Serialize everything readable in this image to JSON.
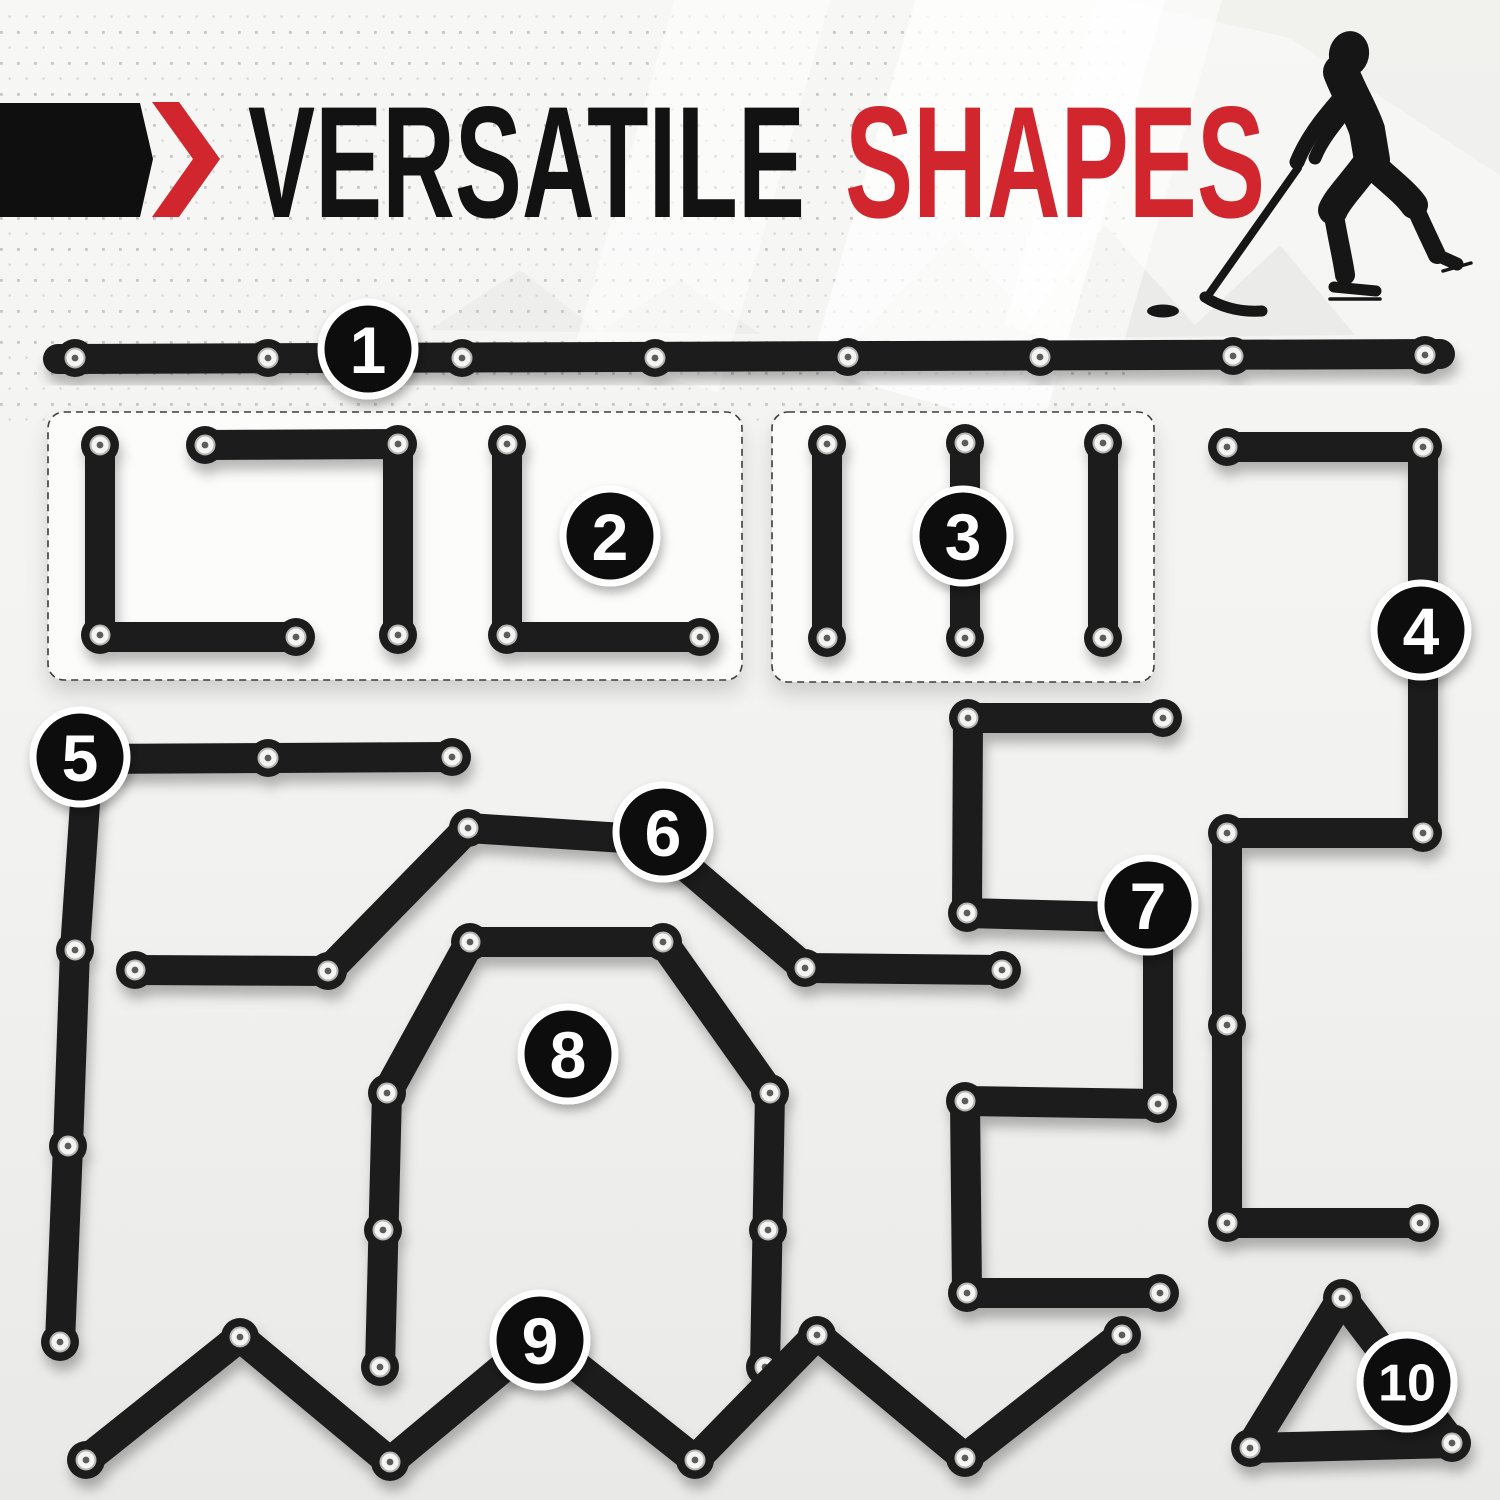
{
  "canvas": {
    "width": 1500,
    "height": 1500
  },
  "header": {
    "title_black": "VERSATILE",
    "title_red": "SHAPES",
    "banner_color": "#0f0f10",
    "accent_red": "#d2262e",
    "title_color": "#121212"
  },
  "icons": {
    "chevron": "right-chevron",
    "player": "hockey-player-silhouette",
    "puck": "hockey-puck"
  },
  "styles": {
    "background_top": "#f7f7f5",
    "background_bottom": "#ebebe9",
    "dot_color": "#bfbfbd",
    "bar_color": "#1c1c1e",
    "bar_width": 30,
    "knuckle_radius": 19,
    "rivet": {
      "face": "#f5f5f4",
      "ring": "#b5b5b3",
      "center": "#5c5c5a"
    },
    "badge": {
      "radius": 47,
      "fill": "#0c0c0c",
      "ring": "#ffffff",
      "text_color": "#ffffff"
    },
    "box": {
      "fill": "#fcfcfb",
      "stroke": "#3d3d3d"
    }
  },
  "boxes": [
    {
      "name": "group-box-shape-2",
      "x": 48,
      "y": 412,
      "w": 694,
      "h": 268
    },
    {
      "name": "group-box-shape-3",
      "x": 772,
      "y": 412,
      "w": 382,
      "h": 270
    }
  ],
  "figures": [
    {
      "id": "shape-1",
      "label": "1",
      "badge": {
        "x": 368,
        "y": 349
      },
      "bars": [
        [
          [
            58,
            359
          ],
          [
            1440,
            354
          ]
        ]
      ],
      "rivets": [
        [
          75,
          358
        ],
        [
          268,
          358
        ],
        [
          462,
          358
        ],
        [
          655,
          358
        ],
        [
          848,
          357
        ],
        [
          1040,
          357
        ],
        [
          1233,
          356
        ],
        [
          1425,
          355
        ]
      ]
    },
    {
      "id": "shape-2",
      "label": "2",
      "badge": {
        "x": 610,
        "y": 536
      },
      "bars": [
        [
          [
            100,
            443
          ],
          [
            100,
            637
          ],
          [
            296,
            637
          ]
        ],
        [
          [
            205,
            445
          ],
          [
            398,
            444
          ],
          [
            398,
            637
          ]
        ],
        [
          [
            507,
            444
          ],
          [
            507,
            637
          ],
          [
            700,
            637
          ]
        ]
      ],
      "rivets": [
        [
          100,
          445
        ],
        [
          100,
          635
        ],
        [
          296,
          637
        ],
        [
          205,
          445
        ],
        [
          398,
          444
        ],
        [
          398,
          635
        ],
        [
          507,
          444
        ],
        [
          507,
          635
        ],
        [
          700,
          637
        ]
      ]
    },
    {
      "id": "shape-3",
      "label": "3",
      "badge": {
        "x": 963,
        "y": 536
      },
      "bars": [
        [
          [
            827,
            444
          ],
          [
            827,
            638
          ]
        ],
        [
          [
            965,
            443
          ],
          [
            965,
            638
          ]
        ],
        [
          [
            1103,
            443
          ],
          [
            1103,
            638
          ]
        ]
      ],
      "rivets": [
        [
          827,
          444
        ],
        [
          827,
          638
        ],
        [
          965,
          443
        ],
        [
          965,
          638
        ],
        [
          1103,
          443
        ],
        [
          1103,
          638
        ]
      ]
    },
    {
      "id": "shape-4",
      "label": "4",
      "badge": {
        "x": 1421,
        "y": 630
      },
      "bars": [
        [
          [
            1227,
            447
          ],
          [
            1423,
            447
          ],
          [
            1423,
            833
          ],
          [
            1227,
            833
          ],
          [
            1227,
            1223
          ],
          [
            1420,
            1223
          ]
        ]
      ],
      "rivets": [
        [
          1227,
          447
        ],
        [
          1423,
          447
        ],
        [
          1423,
          640
        ],
        [
          1423,
          833
        ],
        [
          1227,
          833
        ],
        [
          1227,
          1025
        ],
        [
          1227,
          1223
        ],
        [
          1420,
          1223
        ]
      ]
    },
    {
      "id": "shape-5",
      "label": "5",
      "badge": {
        "x": 80,
        "y": 757
      },
      "bars": [
        [
          [
            452,
            757
          ],
          [
            88,
            759
          ],
          [
            75,
            950
          ],
          [
            68,
            1146
          ],
          [
            60,
            1342
          ]
        ]
      ],
      "rivets": [
        [
          452,
          757
        ],
        [
          268,
          758
        ],
        [
          88,
          759
        ],
        [
          75,
          950
        ],
        [
          68,
          1146
        ],
        [
          60,
          1342
        ]
      ]
    },
    {
      "id": "shape-6",
      "label": "6",
      "badge": {
        "x": 663,
        "y": 832
      },
      "bars": [
        [
          [
            135,
            970
          ],
          [
            328,
            971
          ],
          [
            468,
            828
          ],
          [
            655,
            840
          ],
          [
            805,
            968
          ],
          [
            1002,
            970
          ]
        ]
      ],
      "rivets": [
        [
          135,
          970
        ],
        [
          328,
          971
        ],
        [
          468,
          828
        ],
        [
          655,
          840
        ],
        [
          805,
          968
        ],
        [
          1002,
          970
        ]
      ]
    },
    {
      "id": "shape-7",
      "label": "7",
      "badge": {
        "x": 1148,
        "y": 905
      },
      "bars": [
        [
          [
            1163,
            718
          ],
          [
            968,
            718
          ],
          [
            967,
            913
          ],
          [
            1158,
            918
          ],
          [
            1158,
            1104
          ],
          [
            965,
            1101
          ],
          [
            967,
            1293
          ],
          [
            1160,
            1293
          ]
        ]
      ],
      "rivets": [
        [
          1163,
          718
        ],
        [
          968,
          718
        ],
        [
          967,
          913
        ],
        [
          1158,
          918
        ],
        [
          1158,
          1104
        ],
        [
          965,
          1101
        ],
        [
          967,
          1293
        ],
        [
          1160,
          1293
        ]
      ]
    },
    {
      "id": "shape-8",
      "label": "8",
      "badge": {
        "x": 568,
        "y": 1054
      },
      "bars": [
        [
          [
            380,
            1367
          ],
          [
            387,
            1093
          ],
          [
            470,
            942
          ],
          [
            663,
            942
          ],
          [
            770,
            1093
          ],
          [
            765,
            1367
          ]
        ]
      ],
      "rivets": [
        [
          380,
          1367
        ],
        [
          383,
          1230
        ],
        [
          387,
          1093
        ],
        [
          470,
          942
        ],
        [
          663,
          942
        ],
        [
          770,
          1093
        ],
        [
          768,
          1230
        ],
        [
          765,
          1367
        ]
      ]
    },
    {
      "id": "shape-9",
      "label": "9",
      "badge": {
        "x": 540,
        "y": 1340
      },
      "bars": [
        [
          [
            86,
            1460
          ],
          [
            240,
            1337
          ],
          [
            390,
            1462
          ],
          [
            540,
            1337
          ],
          [
            695,
            1460
          ],
          [
            817,
            1335
          ],
          [
            965,
            1458
          ],
          [
            1122,
            1335
          ]
        ]
      ],
      "rivets": [
        [
          86,
          1460
        ],
        [
          240,
          1337
        ],
        [
          390,
          1462
        ],
        [
          540,
          1337
        ],
        [
          695,
          1460
        ],
        [
          817,
          1335
        ],
        [
          965,
          1458
        ],
        [
          1122,
          1335
        ]
      ]
    },
    {
      "id": "shape-10",
      "label": "10",
      "badge": {
        "x": 1407,
        "y": 1382
      },
      "bars": [
        [
          [
            1342,
            1298
          ],
          [
            1250,
            1448
          ],
          [
            1452,
            1443
          ],
          [
            1342,
            1298
          ]
        ]
      ],
      "rivets": [
        [
          1342,
          1298
        ],
        [
          1250,
          1448
        ],
        [
          1452,
          1443
        ]
      ]
    }
  ]
}
